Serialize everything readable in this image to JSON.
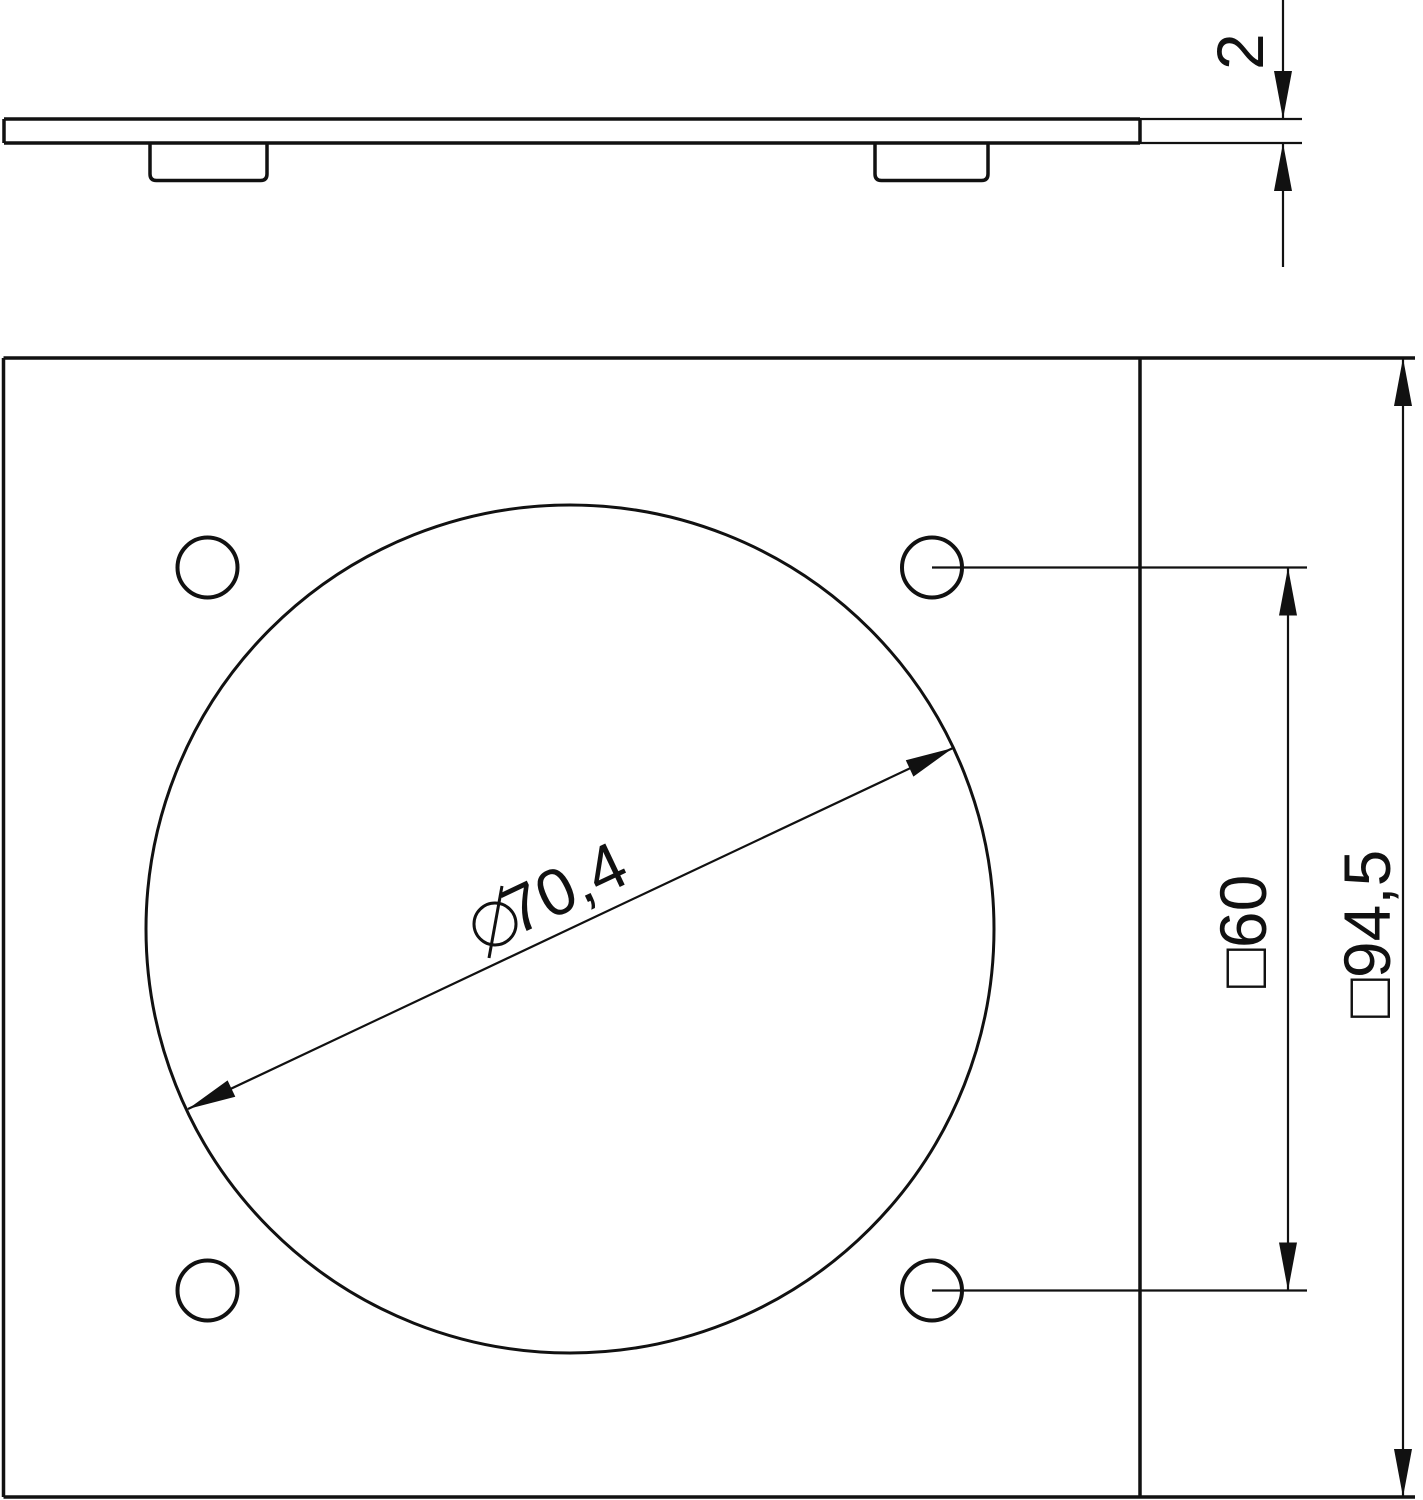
{
  "page": {
    "background": "#ffffff",
    "line_color": "#111111"
  },
  "views": {
    "side_view": {
      "thickness_dim": {
        "value": "2"
      }
    },
    "front_view": {
      "hole_diameter_dim": {
        "symbol": "⌀",
        "value": "70,4"
      },
      "hole_spacing_dim": {
        "value": "□60"
      },
      "plate_size_dim": {
        "value": "□94,5"
      }
    }
  }
}
